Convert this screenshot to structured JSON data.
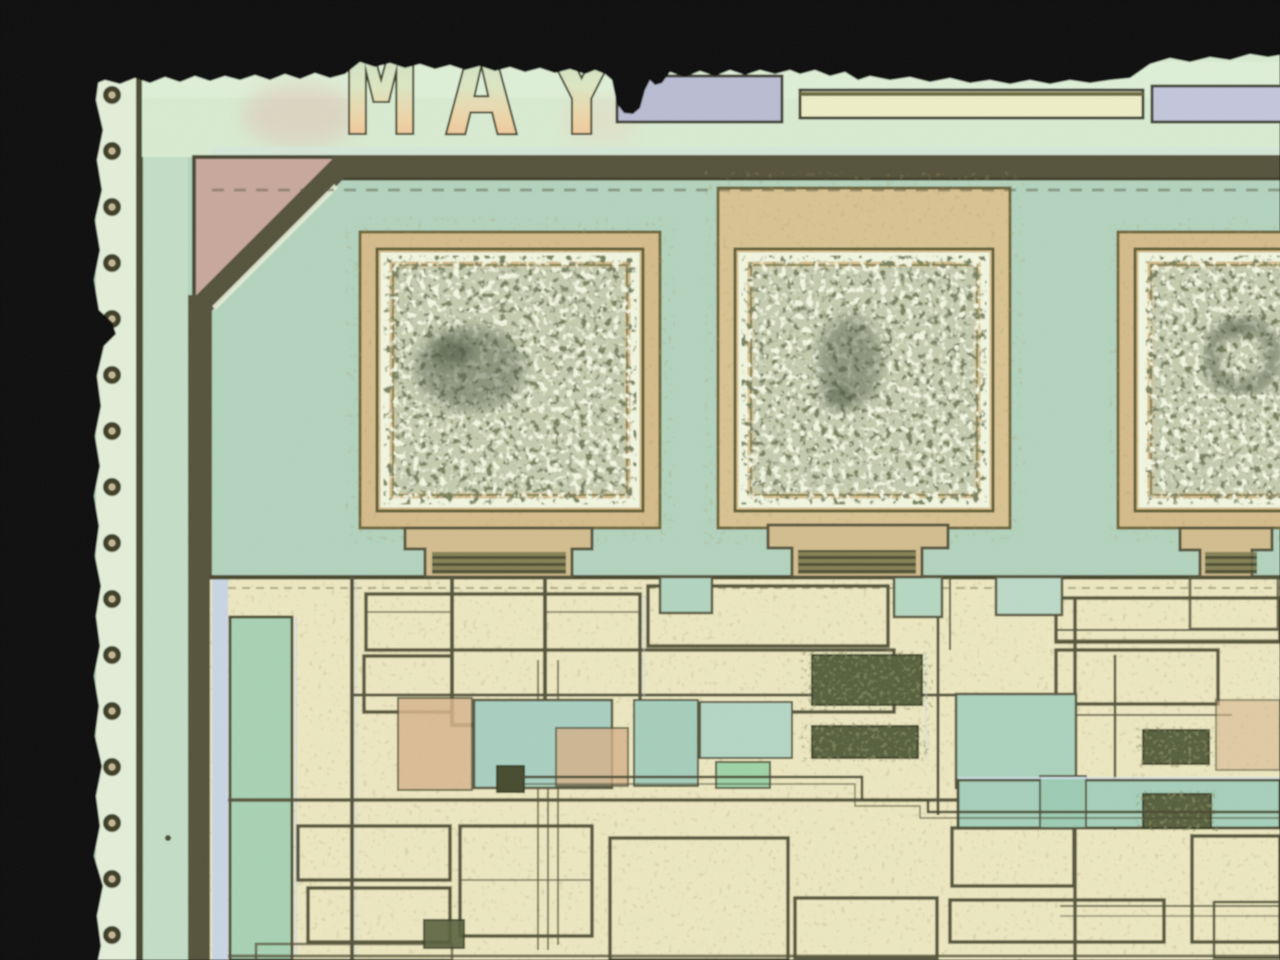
{
  "image": {
    "kind": "microscope photograph of an integrated-circuit die corner",
    "die_label_text": "MAY",
    "bond_pad_count": 3,
    "edge_dot_count": 16,
    "palette": {
      "surround_black": "#0c100c",
      "die_green": "#b3d3bd",
      "edge_strip_cream": "#e3eed8",
      "top_strip_green": "#d8ebd1",
      "seal_ring_dark": "#54523a",
      "corner_chamfer_pink": "#c8a89c",
      "pad_gold": "#d5bb8b",
      "pad_ring_white": "#f1f6df",
      "pad_surface_olive": "#c2c8aa",
      "metal_cream": "#ece7c0",
      "trace_outline": "#55543a",
      "patch_teal": "#a9cfc0",
      "patch_salmon": "#d7b68e",
      "rect_lavender": "#bdc0d4",
      "label_peach": "#f2b488"
    }
  }
}
